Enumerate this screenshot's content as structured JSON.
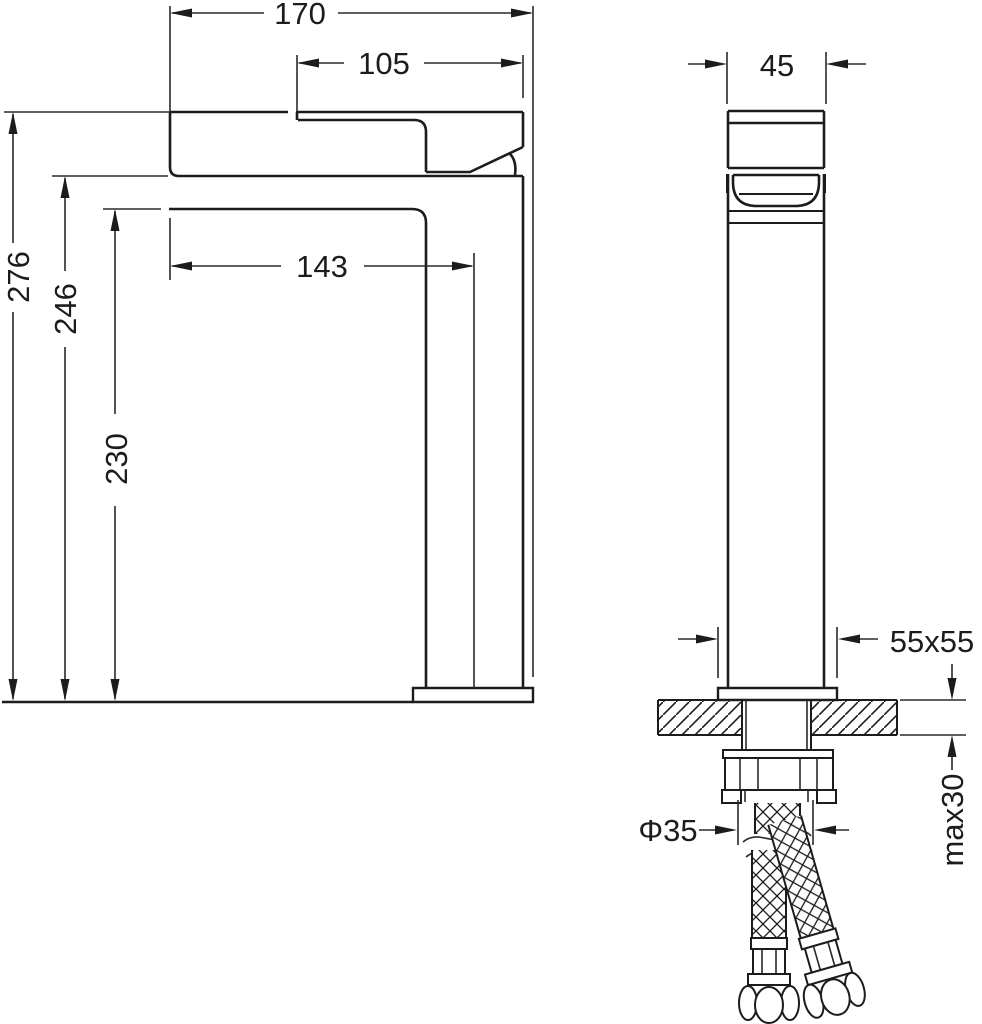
{
  "drawing": {
    "type": "faucet-installation-technical-drawing",
    "background_color": "#ffffff",
    "line_color": "#1c1c1c",
    "views": {
      "side": {
        "label": "side-profile-view",
        "dimensions": {
          "total_projection": "170",
          "spout_offset": "105",
          "spout_reach_to_center": "143",
          "total_height": "276",
          "outlet_height": "246",
          "spout_underside_height": "230"
        }
      },
      "front": {
        "label": "front-view",
        "dimensions": {
          "body_width": "45",
          "base_plate_size": "55x55",
          "shank_diameter": "Φ35",
          "max_counter_thickness": "max30"
        }
      }
    }
  }
}
